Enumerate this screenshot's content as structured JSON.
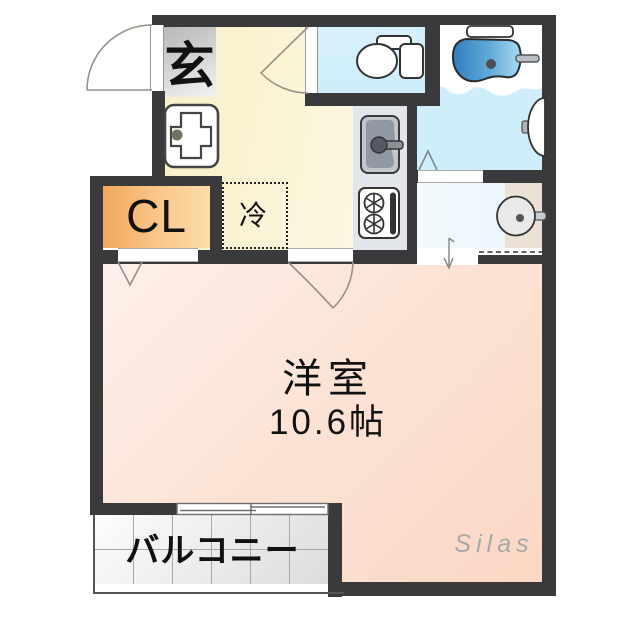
{
  "type": "floorplan",
  "labels": {
    "genkan": "玄",
    "closet": "CL",
    "refrigerator": "冷",
    "room_name": "洋室",
    "room_size": "10.6帖",
    "balcony": "バルコニー",
    "watermark": "Silas"
  },
  "rooms": [
    {
      "name": "entrance",
      "label": "玄"
    },
    {
      "name": "kitchen",
      "label": ""
    },
    {
      "name": "toilet-room",
      "label": ""
    },
    {
      "name": "bathroom",
      "label": ""
    },
    {
      "name": "powder-room",
      "label": ""
    },
    {
      "name": "closet",
      "label": "CL"
    },
    {
      "name": "western-room",
      "label": "洋室 10.6帖"
    },
    {
      "name": "balcony",
      "label": "バルコニー"
    }
  ],
  "fixtures": [
    "entry-door-swing",
    "toilet",
    "bathtub",
    "bath-shelf",
    "bathroom-sink",
    "vanity-sink",
    "washing-machine-pan",
    "kitchen-sink",
    "gas-stove",
    "refrigerator-space",
    "sliding-window",
    "door-swing-arcs"
  ],
  "colors": {
    "wall": "#3a3a3c",
    "kitchen_floor": "#fbf5d8",
    "room_floor": "#fce3d6",
    "toilet_floor": "#d4f0fb",
    "bath_floor": "#cfeefb",
    "tub_blue": "#4a93cc",
    "closet_orange": "#f5b469",
    "genkan_gray": "#d4d4d4",
    "vanity_beige": "#ebe2d5",
    "balcony_tile": "#ececec",
    "watermark_gray": "#a8a8a8"
  }
}
